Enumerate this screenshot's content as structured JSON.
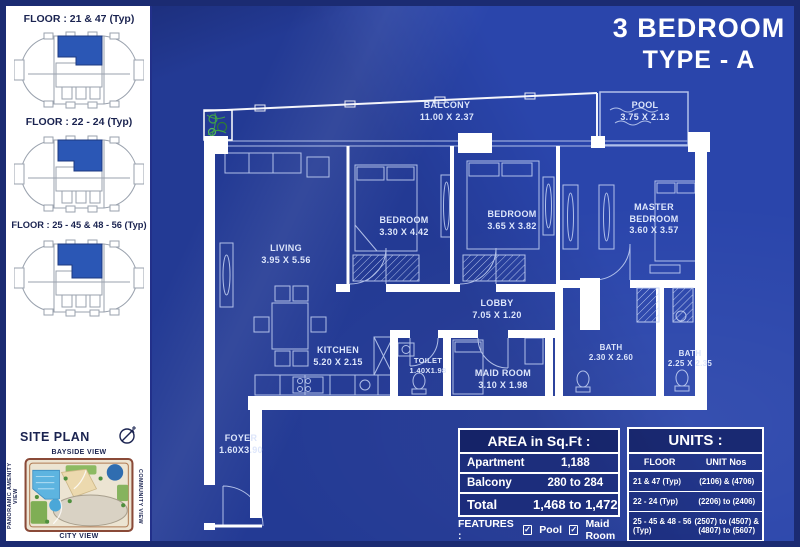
{
  "title": {
    "line1": "3 BEDROOM",
    "line2": "TYPE - A"
  },
  "sidebar": {
    "floors": [
      {
        "label": "FLOOR : 21 & 47 (Typ)"
      },
      {
        "label": "FLOOR : 22 - 24 (Typ)"
      },
      {
        "label": "FLOOR : 25 - 45 & 48 - 56 (Typ)"
      }
    ],
    "site_plan": {
      "title": "SITE PLAN",
      "view_top": "BAYSIDE VIEW",
      "view_bottom": "CITY VIEW",
      "view_left": "PANORAMIC AMENITY VIEW",
      "view_right": "COMMUNITY VIEW"
    }
  },
  "plan": {
    "rooms": [
      {
        "name": "BALCONY",
        "dim": "11.00 X 2.37"
      },
      {
        "name": "POOL",
        "dim": "3.75 X 2.13"
      },
      {
        "name": "LIVING",
        "dim": "3.95 X 5.56"
      },
      {
        "name": "BEDROOM",
        "dim": "3.30 X 4.42"
      },
      {
        "name": "BEDROOM",
        "dim": "3.65 X 3.82"
      },
      {
        "name": "MASTER BEDROOM",
        "dim": "3.60 X 3.57"
      },
      {
        "name": "LOBBY",
        "dim": "7.05 X 1.20"
      },
      {
        "name": "KITCHEN",
        "dim": "5.20 X 2.15"
      },
      {
        "name": "TOILET",
        "dim": "1.40X1.98"
      },
      {
        "name": "MAID ROOM",
        "dim": "3.10 X 1.98"
      },
      {
        "name": "BATH",
        "dim": "2.30 X 2.60"
      },
      {
        "name": "BATH",
        "dim": "2.25 X 2.35"
      },
      {
        "name": "FOYER",
        "dim": "1.60X3.90"
      }
    ]
  },
  "area_table": {
    "header": "AREA in Sq.Ft :",
    "rows": [
      {
        "label": "Apartment",
        "value": "1,188"
      },
      {
        "label": "Balcony",
        "value": "280 to 284"
      },
      {
        "label": "Total",
        "value": "1,468 to 1,472"
      }
    ]
  },
  "features": {
    "label": "FEATURES :",
    "check_glyph": "✓",
    "item1": "Pool",
    "item2": "Maid Room"
  },
  "units_table": {
    "header": "UNITS :",
    "col_floor": "FLOOR",
    "col_units": "UNIT Nos",
    "rows": [
      {
        "floor": "21 & 47 (Typ)",
        "units": "(2106) & (4706)"
      },
      {
        "floor": "22 - 24 (Typ)",
        "units": "(2206) to (2406)"
      },
      {
        "floor": "25 - 45 & 48 - 56 (Typ)",
        "units": "(2507) to (4507) & (4807) to (5607)"
      }
    ]
  },
  "colors": {
    "fabric_blue": "#2a45ab",
    "frame_navy": "#1b2b72",
    "wall_white": "#ffffff",
    "plan_line": "#c9d6f6",
    "unit_highlight": "#2b57b5",
    "sidebar_text": "#1a2350"
  }
}
